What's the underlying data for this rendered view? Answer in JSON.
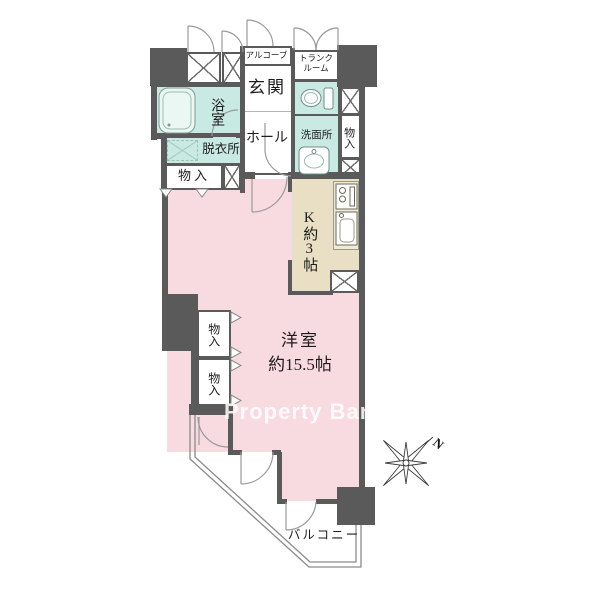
{
  "floorplan": {
    "rooms": {
      "alcove": "アルコーブ",
      "trunk_room": "トランクルーム",
      "entrance": "玄関",
      "hall": "ホール",
      "bath": "浴室",
      "dressing_room": "脱衣所",
      "washroom": "洗面所",
      "storage": "物入",
      "kitchen": "K約3帖",
      "main_room_name": "洋室",
      "main_room_size": "約15.5帖",
      "balcony": "バルコニー"
    },
    "compass": {
      "north_label": "N"
    },
    "watermark": {
      "text": "Property Bank"
    },
    "colors": {
      "wall": "#5a5a5a",
      "pink": "#f8dae1",
      "teal": "#c9eae2",
      "beige": "#e9dfc4",
      "counter": "#f1e9d3"
    }
  }
}
